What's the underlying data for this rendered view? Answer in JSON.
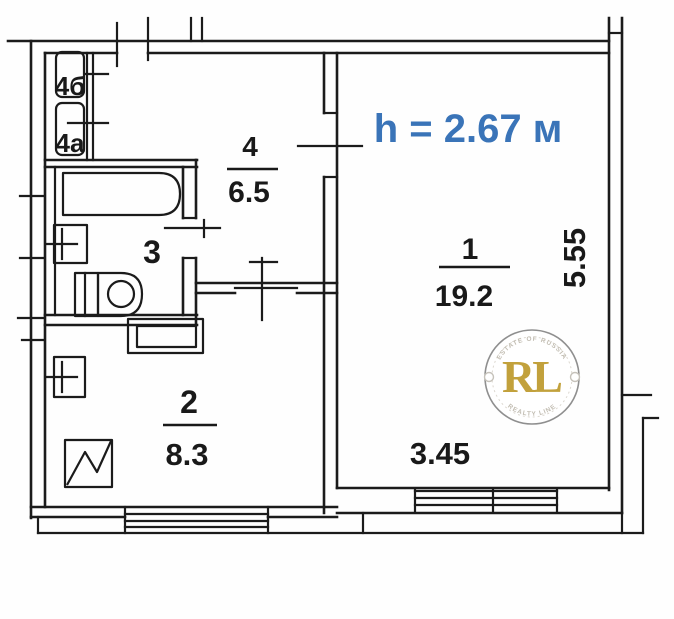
{
  "plan": {
    "ceiling_height_label": "h = 2.67 м",
    "rooms": [
      {
        "number": "1",
        "area": "19.2"
      },
      {
        "number": "2",
        "area": "8.3"
      },
      {
        "number": "3",
        "area": ""
      },
      {
        "number": "4",
        "area": "6.5"
      },
      {
        "number": "4а",
        "area": ""
      },
      {
        "number": "4б",
        "area": ""
      }
    ],
    "dimensions": {
      "horizontal": "3.45",
      "vertical": "5.55"
    },
    "colors": {
      "wall": "#1b1b1b",
      "ceiling_height_text": "#3a74b8",
      "watermark_gold": "#c2a13c",
      "watermark_ring": "#8f8f8f"
    },
    "watermark": {
      "initials": "RL",
      "top_text": "ESTATE OF RUSSIA",
      "bottom_text": "REALTY LINE"
    }
  }
}
